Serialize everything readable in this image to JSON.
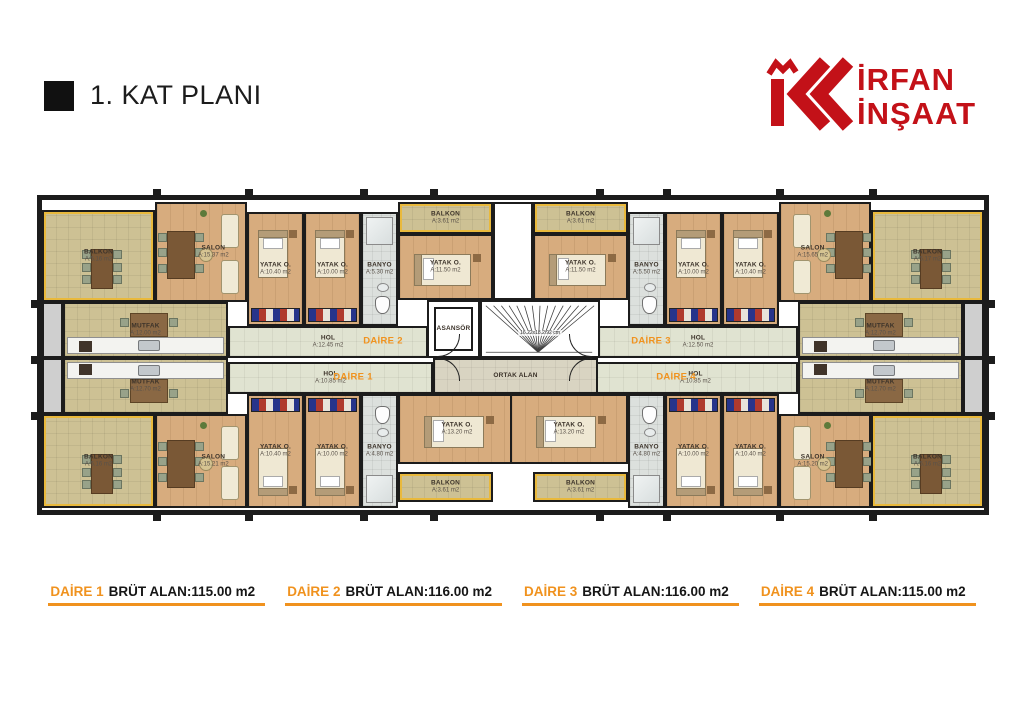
{
  "title": "1. KAT PLANI",
  "logo": {
    "line1": "İRFAN",
    "line2": "İNŞAAT"
  },
  "colors": {
    "accent_orange": "#f0921e",
    "logo_red": "#c31118"
  },
  "plan": {
    "daire_tags": [
      {
        "label": "DAİRE 1",
        "x": 315,
        "y": 181
      },
      {
        "label": "DAİRE 2",
        "x": 345,
        "y": 145
      },
      {
        "label": "DAİRE 3",
        "x": 613,
        "y": 145
      },
      {
        "label": "DAİRE 4",
        "x": 638,
        "y": 181
      }
    ],
    "rooms": [
      {
        "name": "BALKON",
        "area": "A:5.16 m2",
        "type": "balcony-large",
        "x": 4,
        "y": 14,
        "w": 113,
        "h": 92
      },
      {
        "name": "SALON",
        "area": "A:15.37 m2",
        "type": "salon",
        "x": 117,
        "y": 6,
        "w": 92,
        "h": 100
      },
      {
        "name": "YATAK O.",
        "area": "A:10.40 m2",
        "type": "bedroom",
        "x": 209,
        "y": 16,
        "w": 57,
        "h": 114,
        "wardrobe": "bottom"
      },
      {
        "name": "YATAK O.",
        "area": "A:10.00 m2",
        "type": "bedroom",
        "x": 266,
        "y": 16,
        "w": 57,
        "h": 114,
        "wardrobe": "bottom"
      },
      {
        "name": "BANYO",
        "area": "A:5.30 m2",
        "type": "bath",
        "x": 323,
        "y": 16,
        "w": 37,
        "h": 114
      },
      {
        "name": "BALKON",
        "area": "A:3.61 m2",
        "type": "balcony-small",
        "x": 360,
        "y": 6,
        "w": 95,
        "h": 32
      },
      {
        "name": "YATAK O.",
        "area": "A:11.50 m2",
        "type": "bedroom",
        "x": 360,
        "y": 38,
        "w": 95,
        "h": 66,
        "bed": "h"
      },
      {
        "name": "MUTFAK",
        "area": "A:12.00 m2",
        "type": "kitchen",
        "x": 25,
        "y": 106,
        "w": 165,
        "h": 56,
        "counter": "bottom"
      },
      {
        "name": "HOL",
        "area": "A:12.45 m2",
        "type": "hall",
        "x": 190,
        "y": 130,
        "w": 200,
        "h": 32
      },
      {
        "name": "BALKON",
        "area": "A:3.61 m2",
        "type": "balcony-small",
        "x": 495,
        "y": 6,
        "w": 95,
        "h": 32
      },
      {
        "name": "YATAK O.",
        "area": "A:11.50 m2",
        "type": "bedroom",
        "x": 495,
        "y": 38,
        "w": 95,
        "h": 66,
        "bed": "h"
      },
      {
        "name": "BANYO",
        "area": "A:5.50 m2",
        "type": "bath",
        "x": 590,
        "y": 16,
        "w": 37,
        "h": 114
      },
      {
        "name": "YATAK O.",
        "area": "A:10.00 m2",
        "type": "bedroom",
        "x": 627,
        "y": 16,
        "w": 57,
        "h": 114,
        "wardrobe": "bottom"
      },
      {
        "name": "YATAK O.",
        "area": "A:10.40 m2",
        "type": "bedroom",
        "x": 684,
        "y": 16,
        "w": 57,
        "h": 114,
        "wardrobe": "bottom"
      },
      {
        "name": "SALON",
        "area": "A:15.65 m2",
        "type": "salon",
        "x": 741,
        "y": 6,
        "w": 92,
        "h": 100
      },
      {
        "name": "BALKON",
        "area": "A:5.17 m2",
        "type": "balcony-large",
        "x": 833,
        "y": 14,
        "w": 113,
        "h": 92
      },
      {
        "name": "HOL",
        "area": "A:12.50 m2",
        "type": "hall",
        "x": 560,
        "y": 130,
        "w": 200,
        "h": 32
      },
      {
        "name": "MUTFAK",
        "area": "A:12.70 m2",
        "type": "kitchen",
        "x": 760,
        "y": 106,
        "w": 165,
        "h": 56,
        "counter": "bottom"
      },
      {
        "name": "HOL",
        "area": "A:10.85 m2",
        "type": "hall",
        "x": 190,
        "y": 166,
        "w": 205,
        "h": 32
      },
      {
        "name": "MUTFAK",
        "area": "A:12.70 m2",
        "type": "kitchen",
        "x": 25,
        "y": 162,
        "w": 165,
        "h": 56,
        "counter": "top"
      },
      {
        "name": "BALKON",
        "area": "A:5.16 m2",
        "type": "balcony-large",
        "x": 4,
        "y": 218,
        "w": 113,
        "h": 94
      },
      {
        "name": "SALON",
        "area": "A:15.21 m2",
        "type": "salon",
        "x": 117,
        "y": 218,
        "w": 92,
        "h": 94
      },
      {
        "name": "YATAK O.",
        "area": "A:10.40 m2",
        "type": "bedroom",
        "x": 209,
        "y": 198,
        "w": 57,
        "h": 114,
        "wardrobe": "top"
      },
      {
        "name": "YATAK O.",
        "area": "A:10.00 m2",
        "type": "bedroom",
        "x": 266,
        "y": 198,
        "w": 57,
        "h": 114,
        "wardrobe": "top"
      },
      {
        "name": "BANYO",
        "area": "A:4.80 m2",
        "type": "bath",
        "x": 323,
        "y": 198,
        "w": 37,
        "h": 114
      },
      {
        "name": "YATAK O.",
        "area": "A:13.20 m2",
        "type": "bedroom",
        "x": 360,
        "y": 198,
        "w": 118,
        "h": 70,
        "bed": "h"
      },
      {
        "name": "BALKON",
        "area": "A:3.61 m2",
        "type": "balcony-small",
        "x": 360,
        "y": 276,
        "w": 95,
        "h": 30
      },
      {
        "name": "HOL",
        "area": "A:10.85 m2",
        "type": "hall",
        "x": 555,
        "y": 166,
        "w": 205,
        "h": 32
      },
      {
        "name": "MUTFAK",
        "area": "A:12.70 m2",
        "type": "kitchen",
        "x": 760,
        "y": 162,
        "w": 165,
        "h": 56,
        "counter": "top"
      },
      {
        "name": "YATAK O.",
        "area": "A:13.20 m2",
        "type": "bedroom",
        "x": 472,
        "y": 198,
        "w": 118,
        "h": 70,
        "bed": "h"
      },
      {
        "name": "BALKON",
        "area": "A:3.61 m2",
        "type": "balcony-small",
        "x": 495,
        "y": 276,
        "w": 95,
        "h": 30
      },
      {
        "name": "BANYO",
        "area": "A:4.80 m2",
        "type": "bath",
        "x": 590,
        "y": 198,
        "w": 37,
        "h": 114
      },
      {
        "name": "YATAK O.",
        "area": "A:10.00 m2",
        "type": "bedroom",
        "x": 627,
        "y": 198,
        "w": 57,
        "h": 114,
        "wardrobe": "top"
      },
      {
        "name": "YATAK O.",
        "area": "A:10.40 m2",
        "type": "bedroom",
        "x": 684,
        "y": 198,
        "w": 57,
        "h": 114,
        "wardrobe": "top"
      },
      {
        "name": "SALON",
        "area": "A:15.20 m2",
        "type": "salon",
        "x": 741,
        "y": 218,
        "w": 92,
        "h": 94
      },
      {
        "name": "BALKON",
        "area": "A:5.16 m2",
        "type": "balcony-large",
        "x": 833,
        "y": 218,
        "w": 113,
        "h": 94
      },
      {
        "name": "ASANSÖR",
        "type": "elevator",
        "x": 389,
        "y": 104,
        "w": 53,
        "h": 58
      },
      {
        "type": "stairs",
        "dim": "16.22x18.2/92 cm",
        "x": 442,
        "y": 104,
        "w": 120,
        "h": 58
      },
      {
        "name": "ORTAK ALAN",
        "type": "ortak",
        "x": 395,
        "y": 162,
        "w": 165,
        "h": 36
      },
      {
        "type": "void",
        "x": 455,
        "y": 6,
        "w": 40,
        "h": 98
      },
      {
        "type": "shaft",
        "x": 4,
        "y": 106,
        "w": 21,
        "h": 56
      },
      {
        "type": "shaft",
        "x": 4,
        "y": 162,
        "w": 21,
        "h": 56
      },
      {
        "type": "shaft",
        "x": 925,
        "y": 106,
        "w": 21,
        "h": 56
      },
      {
        "type": "shaft",
        "x": 925,
        "y": 162,
        "w": 21,
        "h": 56
      }
    ]
  },
  "legend": [
    {
      "daire": "DAİRE 1",
      "rest": "BRÜT ALAN:115.00 m2"
    },
    {
      "daire": "DAİRE 2",
      "rest": "BRÜT ALAN:116.00 m2"
    },
    {
      "daire": "DAİRE 3",
      "rest": "BRÜT ALAN:116.00 m2"
    },
    {
      "daire": "DAİRE 4",
      "rest": "BRÜT ALAN:115.00 m2"
    }
  ]
}
